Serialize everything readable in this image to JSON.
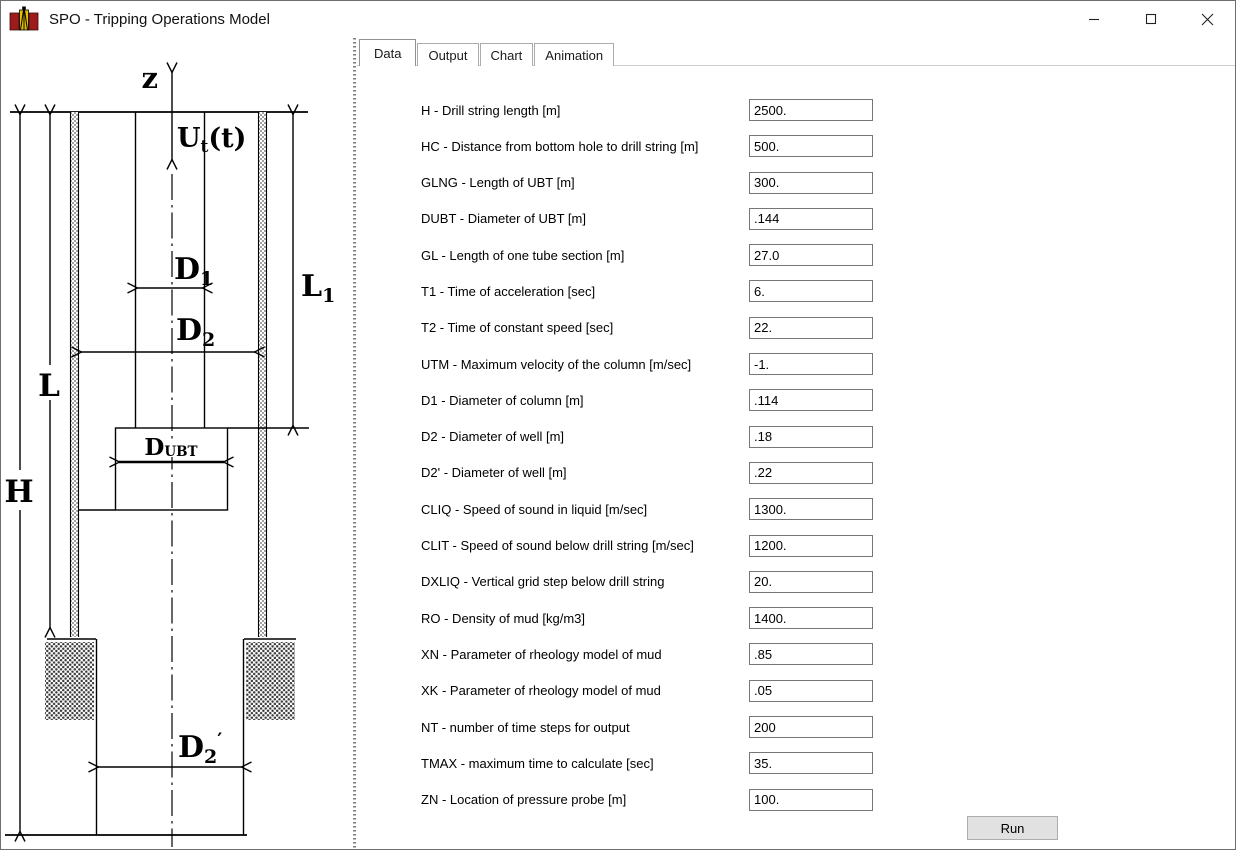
{
  "window": {
    "title": "SPO - Tripping Operations Model"
  },
  "tabs": [
    {
      "label": "Data",
      "selected": true
    },
    {
      "label": "Output",
      "selected": false
    },
    {
      "label": "Chart",
      "selected": false
    },
    {
      "label": "Animation",
      "selected": false
    }
  ],
  "form": {
    "fields": [
      {
        "label": "H - Drill string length [m]",
        "value": "2500."
      },
      {
        "label": "HC - Distance from bottom hole to drill string [m]",
        "value": "500."
      },
      {
        "label": "GLNG - Length of UBT [m]",
        "value": "300."
      },
      {
        "label": "DUBT - Diameter of UBT [m]",
        "value": ".144"
      },
      {
        "label": "GL - Length of one tube section [m]",
        "value": "27.0"
      },
      {
        "label": "T1 - Time of acceleration [sec]",
        "value": "6."
      },
      {
        "label": "T2 - Time of constant speed [sec]",
        "value": "22."
      },
      {
        "label": "UTM - Maximum velocity of the column [m/sec]",
        "value": "-1."
      },
      {
        "label": "D1 - Diameter of column [m]",
        "value": ".114"
      },
      {
        "label": "D2 - Diameter of well [m]",
        "value": ".18"
      },
      {
        "label": "D2' - Diameter of well [m]",
        "value": ".22"
      },
      {
        "label": "CLIQ - Speed of sound in liquid [m/sec]",
        "value": "1300."
      },
      {
        "label": "CLIT - Speed of sound below drill string [m/sec]",
        "value": "1200."
      },
      {
        "label": "DXLIQ - Vertical grid step below drill string",
        "value": "20."
      },
      {
        "label": "RO - Density of mud [kg/m3]",
        "value": "1400."
      },
      {
        "label": "XN - Parameter of rheology model of mud",
        "value": ".85"
      },
      {
        "label": "XK - Parameter of rheology model of mud",
        "value": ".05"
      },
      {
        "label": "NT - number of time steps for output",
        "value": "200"
      },
      {
        "label": "TMAX - maximum time to calculate [sec]",
        "value": "35."
      },
      {
        "label": "ZN - Location of pressure probe [m]",
        "value": "100."
      }
    ],
    "run_label": "Run"
  },
  "diagram": {
    "labels": {
      "z_axis": "z",
      "velocity": {
        "pre": "U",
        "sub": "t",
        "post": "(t)"
      },
      "d1": {
        "pre": "D",
        "sub": "1"
      },
      "d2": {
        "pre": "D",
        "sub": "2"
      },
      "l1": {
        "pre": "L",
        "sub": "1"
      },
      "l": "L",
      "h": "H",
      "dubt": {
        "pre": "D",
        "sub": "UBT"
      },
      "d2prime": {
        "pre": "D",
        "sub": "2",
        "prime": "′"
      }
    }
  },
  "colors": {
    "icon_red": "#9e1b1b",
    "icon_yellow": "#e3c000",
    "run_button_bg": "#e1e1e1",
    "diagram_ink": "#000000"
  }
}
